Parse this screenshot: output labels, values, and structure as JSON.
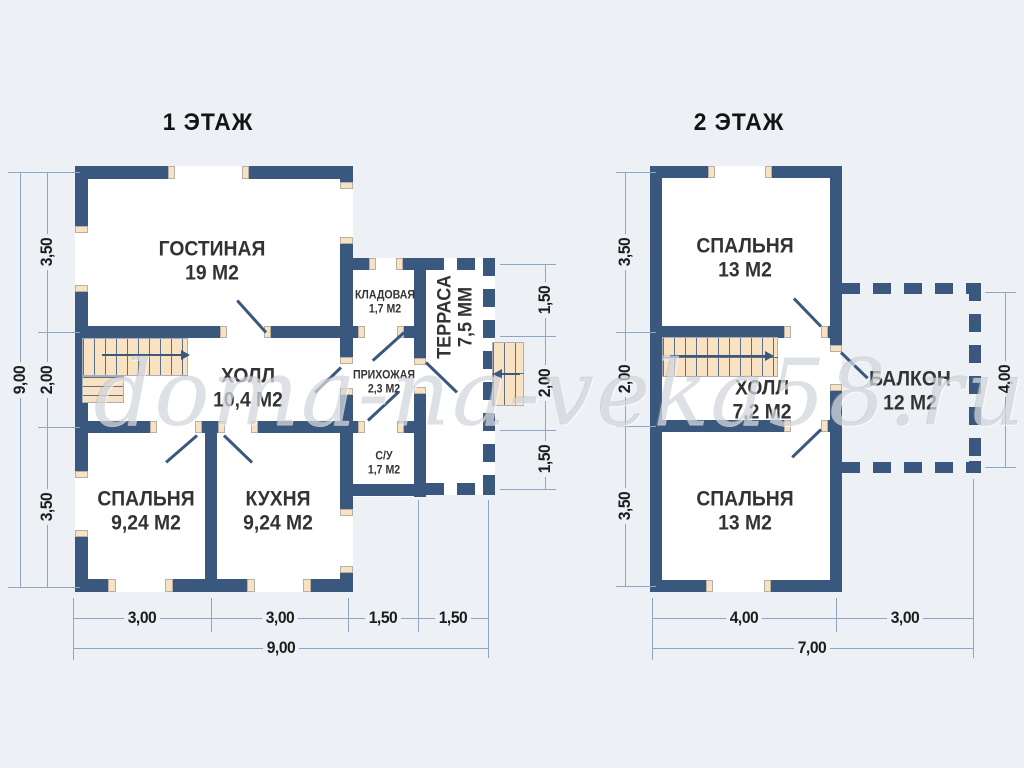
{
  "watermark": "doma-na-veka58.ru",
  "colors": {
    "wall": "#3a587d",
    "stair": "#f8e2c2",
    "background": "#edf0f4",
    "dim_line": "#8ba6c6"
  },
  "floor1": {
    "title": "1 ЭТАЖ",
    "rooms": {
      "living": {
        "name": "ГОСТИНАЯ",
        "area": "19 М2"
      },
      "hall": {
        "name": "ХОЛЛ",
        "area": "10,4 М2"
      },
      "bedroom": {
        "name": "СПАЛЬНЯ",
        "area": "9,24 М2"
      },
      "kitchen": {
        "name": "КУХНЯ",
        "area": "9,24 М2"
      },
      "storage": {
        "name": "КЛАДОВАЯ",
        "area": "1,7 М2"
      },
      "entry": {
        "name": "ПРИХОЖАЯ",
        "area": "2,3 М2"
      },
      "wc": {
        "name": "С/У",
        "area": "1,7 М2"
      },
      "terrace": {
        "name": "ТЕРРАСА",
        "area": "7,5 ММ"
      }
    },
    "dims": {
      "left_total": "9,00",
      "left_segments": [
        "3,50",
        "2,00",
        "3,50"
      ],
      "bottom_segments": [
        "3,00",
        "3,00",
        "1,50",
        "1,50"
      ],
      "bottom_total": "9,00",
      "terrace_segments": [
        "1,50",
        "2,00",
        "1,50"
      ]
    }
  },
  "floor2": {
    "title": "2 ЭТАЖ",
    "rooms": {
      "bedroom_top": {
        "name": "СПАЛЬНЯ",
        "area": "13 М2"
      },
      "hall": {
        "name": "ХОЛЛ",
        "area": "7,2 М2"
      },
      "bedroom_bottom": {
        "name": "СПАЛЬНЯ",
        "area": "13 М2"
      },
      "balcony": {
        "name": "БАЛКОН",
        "area": "12 М2"
      }
    },
    "dims": {
      "left_segments": [
        "3,50",
        "2,00",
        "3,50"
      ],
      "bottom_segments": [
        "4,00",
        "3,00"
      ],
      "bottom_total": "7,00",
      "balcony_right": "4,00"
    }
  }
}
